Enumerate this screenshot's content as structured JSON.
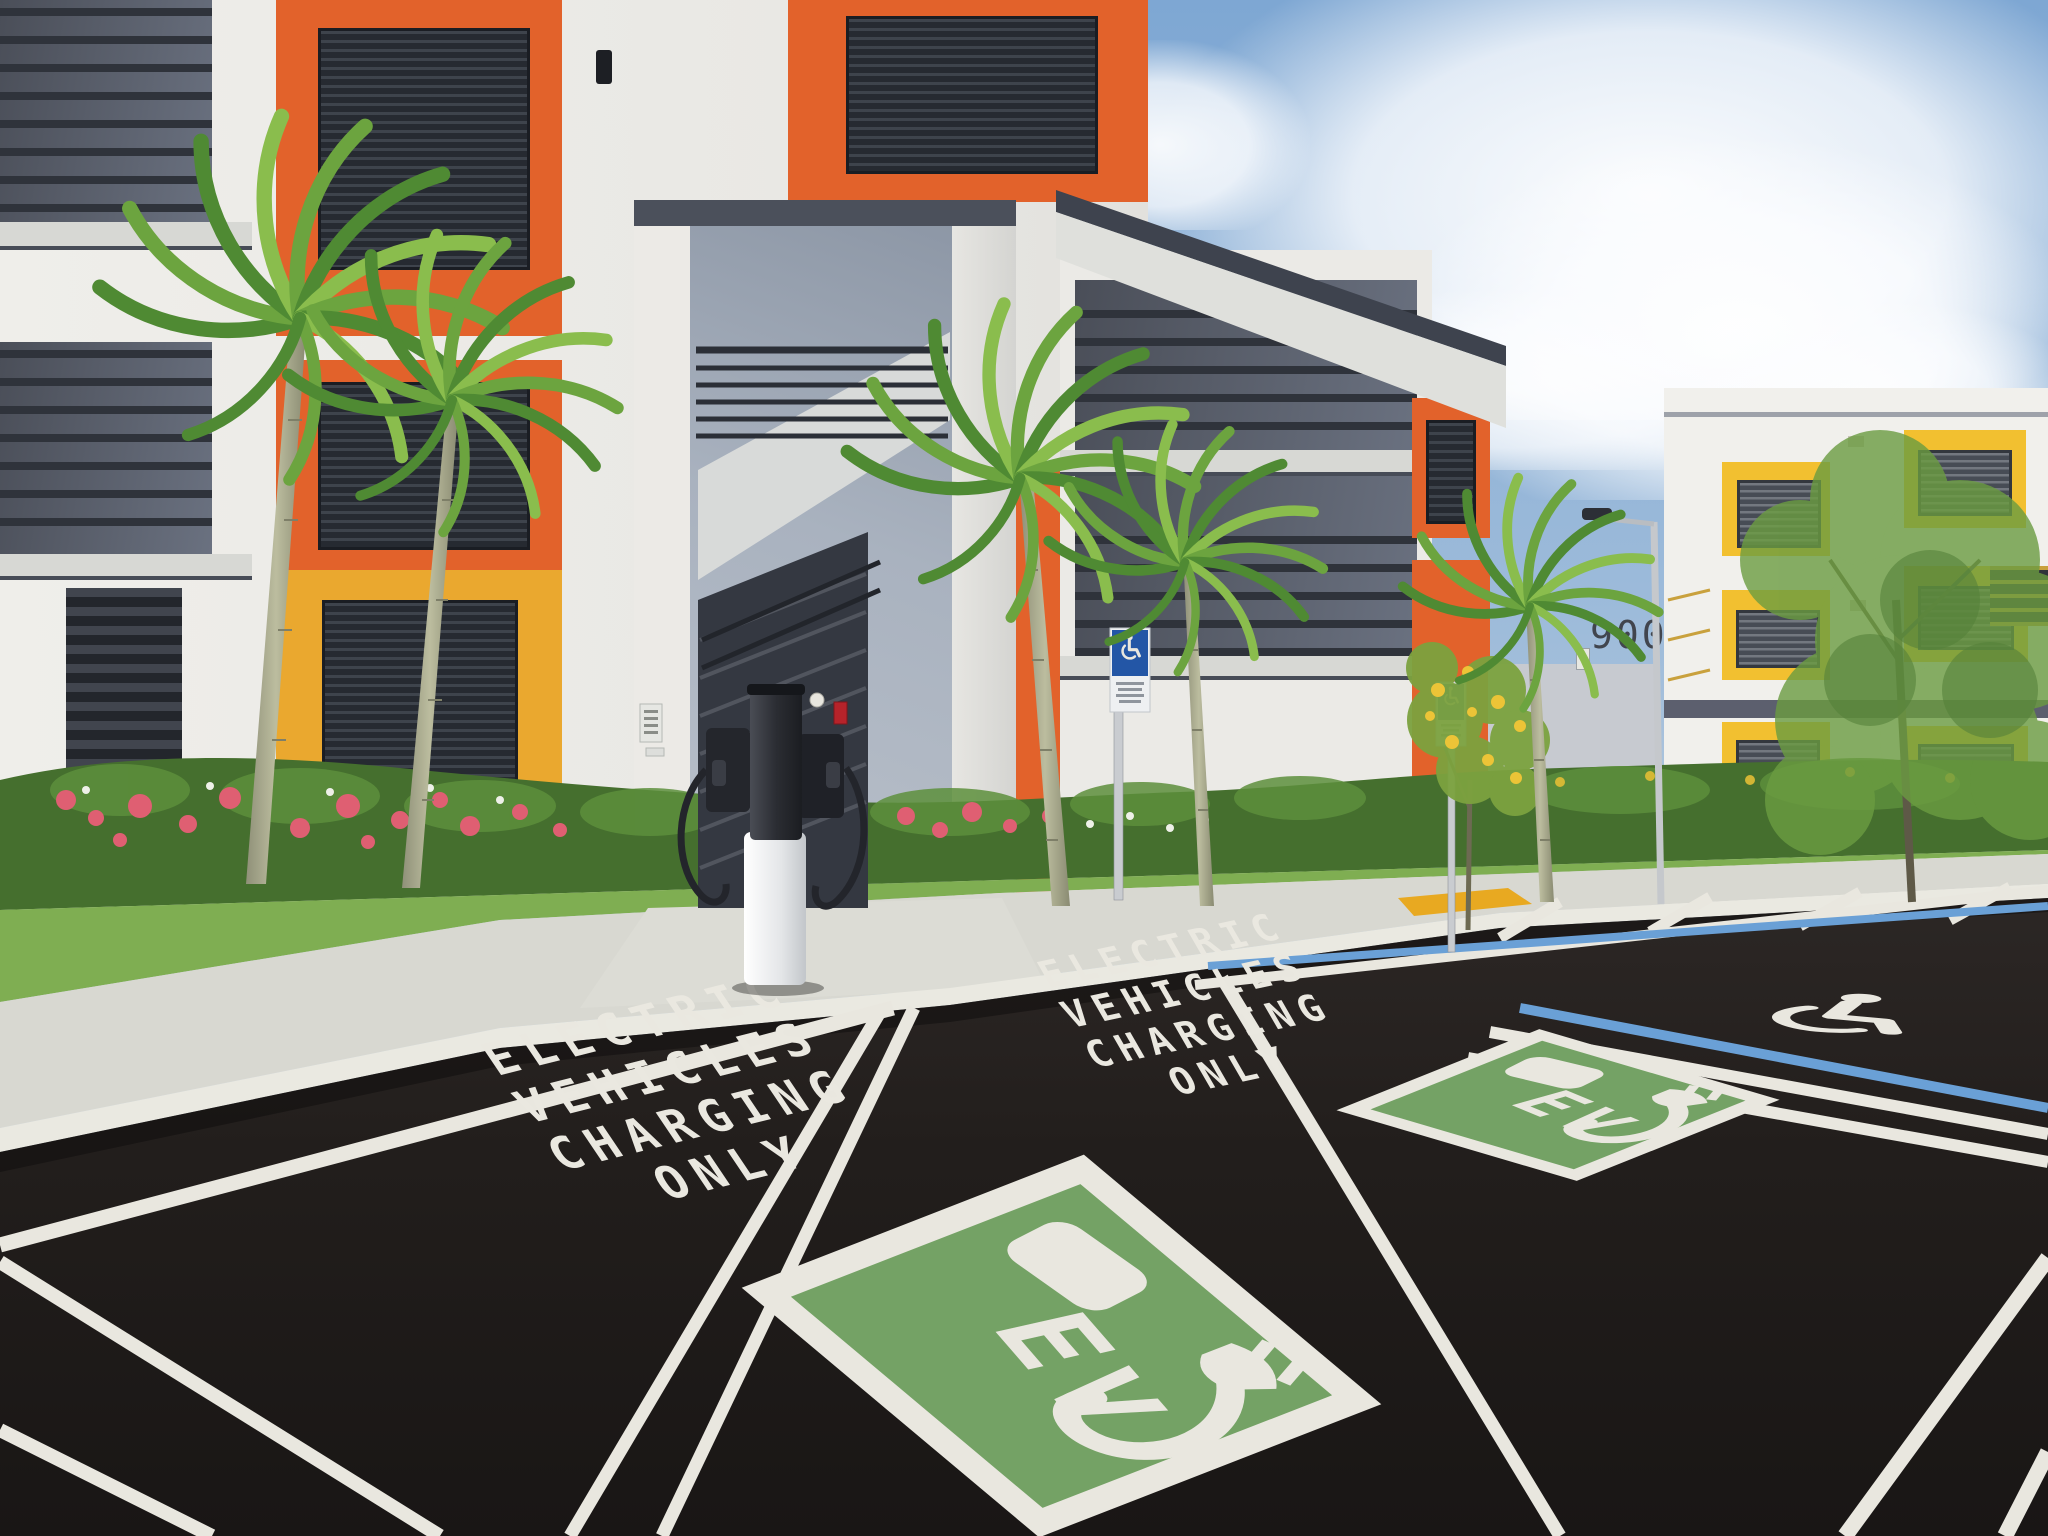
{
  "photo": {
    "building": {
      "number": "900"
    },
    "pavement": {
      "stencil_left": {
        "lines": [
          "ELECTRIC",
          "VEHICLES",
          "CHARGING",
          "ONLY"
        ]
      },
      "stencil_right": {
        "lines": [
          "ELECTRIC",
          "VEHICLES",
          "CHARGING",
          "ONLY"
        ]
      },
      "ev_badge_left": {
        "label": "EV"
      },
      "ev_badge_right": {
        "label": "EV"
      }
    },
    "colors": {
      "accent_orange": "#E2622B",
      "accent_yellow": "#F2C030",
      "ev_green": "#74A265",
      "ada_sign_blue": "#2356A6",
      "pavement_line_blue": "#6AA0D6",
      "pavement_line_white": "#E9E7DF",
      "asphalt": "#201C1A",
      "sky_blue": "#7EA7D3",
      "palm_green": "#6CA43F",
      "flower_pink": "#DF5F72"
    }
  }
}
